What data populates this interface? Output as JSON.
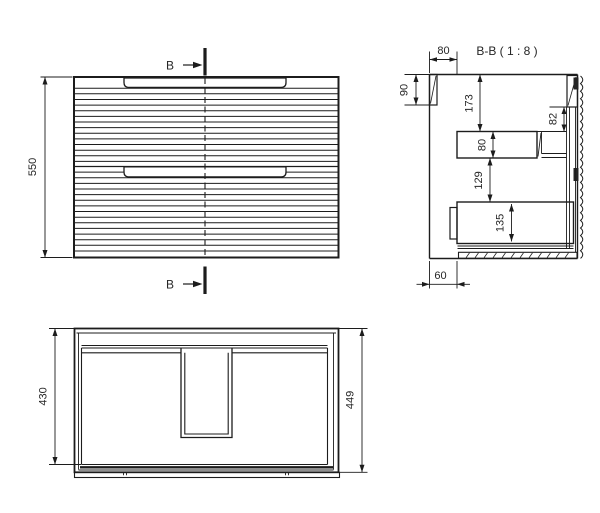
{
  "colors": {
    "background": "#ffffff",
    "line": "#1c1c1c",
    "text": "#262626"
  },
  "front_view": {
    "height_dim": "550",
    "section_marker_top": "B",
    "section_marker_bottom": "B"
  },
  "section_view": {
    "title": "B-B ( 1 : 8 )",
    "front_offset_dim": "80",
    "top_rail_dim": "90",
    "top_clearance_dim": "173",
    "back_rail_dim": "82",
    "upper_drawer_dim": "80",
    "drawer_gap_dim": "129",
    "lower_drawer_dim": "135",
    "plinth_recess_dim": "60"
  },
  "plan_view": {
    "inner_depth_dim": "430",
    "outer_depth_dim": "449"
  }
}
